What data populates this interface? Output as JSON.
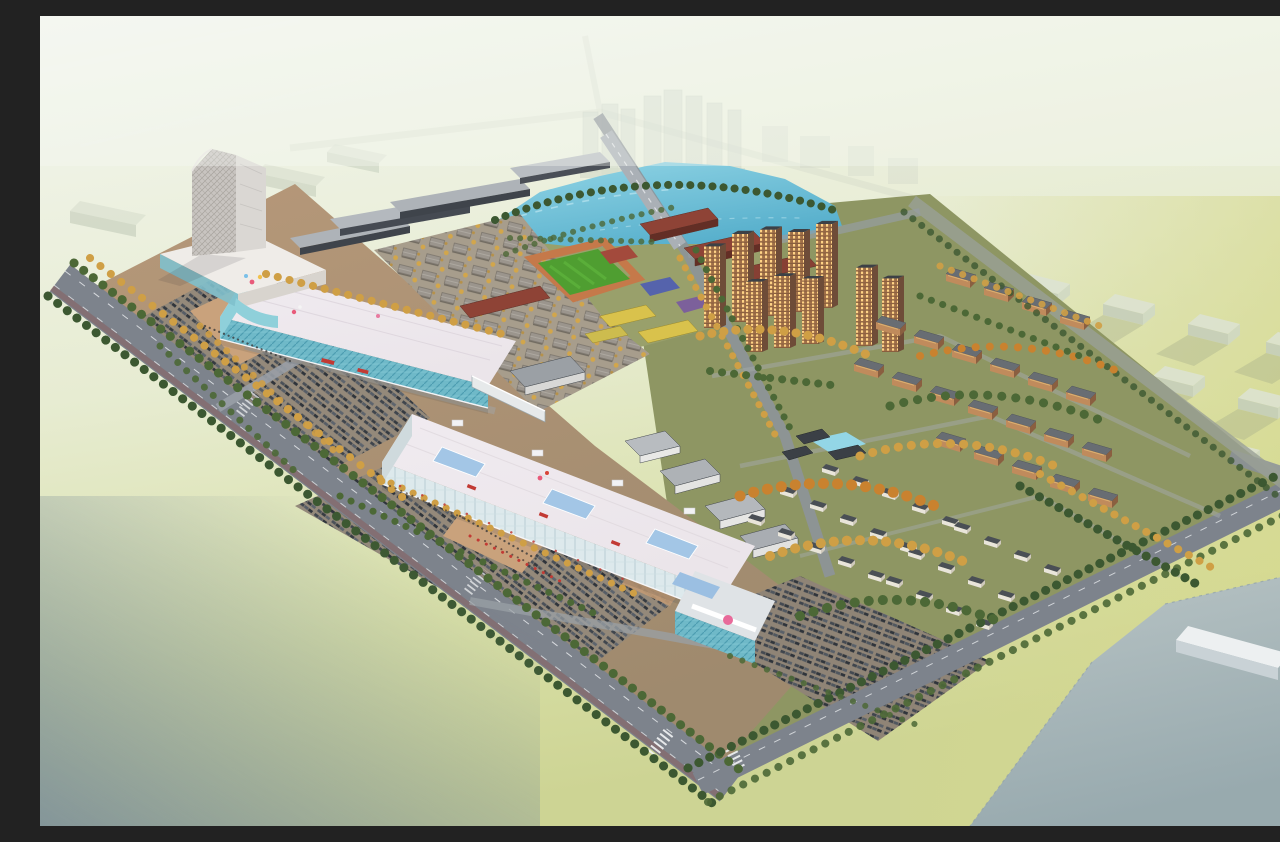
{
  "meta": {
    "title": "Aerial dusk rendering of a mixed-use development master plan",
    "type": "architectural-rendering",
    "view": "bird's-eye aerial",
    "time_of_day": "dusk"
  },
  "palette": {
    "bg_top": "#f3f6f0",
    "bg_mid": "#e7ecd2",
    "bg_green": "#d8dfa6",
    "bg_yellow": "#d6d98e",
    "corner_slate": "#7b8e99",
    "ghost_building": "#dde3d4",
    "ghost_shadow": "#9aa486",
    "parcel": "#b7c3ca",
    "white_slab": "#edf0f1",
    "site_tan": "#b69879",
    "site_tan_dark": "#9f8a6e",
    "site_residential": "#8e9663",
    "school_ground": "#99a06b",
    "road": "#7d838c",
    "road_minor": "#999fa6",
    "lane_marking": "#eceff1",
    "pond_deep": "#55aecb",
    "pond_light": "#93d6e6",
    "field_green": "#4f9e31",
    "track_orange": "#c5794a",
    "school_brick": "#8e4336",
    "kindergarten_yellow": "#d9c24c",
    "court_blue": "#5563ac",
    "court_red": "#a34a3c",
    "mall_roof": "#ebe5ea",
    "mall_glass": "#6fb9c8",
    "glass_light": "#8fd0da",
    "skylight_blue": "#a3c6e6",
    "tower_facade": "#c8c4c0",
    "tower_side": "#dad7d3",
    "podium_white": "#efece8",
    "townhouse_roof": "#9b958d",
    "tree_green": "#4c6836",
    "tree_autumn": "#cf9f45",
    "tree_orange": "#c9822f",
    "tree_dark": "#3c5831",
    "residential_wall": "#9f6f48",
    "residential_shade": "#6e4c38",
    "window_gold": "#ffd386",
    "roof_dark": "#3c4046",
    "midrise_roof": "#686d73",
    "midrise_wall": "#c08b5c",
    "villa_roof": "#4a4f55",
    "villa_wall": "#e9e5da",
    "parking_ground": "#94897a",
    "car_dark": "#3f454d",
    "plaza": "#c9a27c",
    "balloon_pink": "#e85a7a",
    "banner_red": "#c23a34",
    "logo_pink": "#e86a9a"
  },
  "scene": {
    "landmarks": [
      {
        "id": "office-tower",
        "label": "high-rise office tower with diagrid facade"
      },
      {
        "id": "retail-podium",
        "label": "white retail podium"
      },
      {
        "id": "shopping-mall-west",
        "label": "shopping mall block A with teal glass"
      },
      {
        "id": "shopping-mall-east",
        "label": "shopping mall block B with blue skylights"
      },
      {
        "id": "sky-bridge",
        "label": "sky bridge between malls"
      },
      {
        "id": "entrance-pavilion",
        "label": "glass entrance pavilion with pink logo"
      },
      {
        "id": "row-house-grid",
        "label": "dense grid of gray row houses"
      },
      {
        "id": "industrial-halls",
        "label": "long flat-roofed halls"
      },
      {
        "id": "school-campus",
        "label": "red-brick school campus"
      },
      {
        "id": "sports-field",
        "label": "soccer field with running track"
      },
      {
        "id": "kindergarten",
        "label": "yellow kindergarten buildings"
      },
      {
        "id": "pond",
        "label": "blue pond crossed by a road bridge"
      },
      {
        "id": "high-rise-cluster",
        "label": "orange residential towers with lit windows"
      },
      {
        "id": "midrise-apartments",
        "label": "mid-rise apartment blocks"
      },
      {
        "id": "villa-district",
        "label": "villa district with autumn trees"
      },
      {
        "id": "courtyard-garden",
        "label": "courtyard garden with small pond"
      },
      {
        "id": "parking-lots",
        "label": "surface parking lots full of cars"
      },
      {
        "id": "boulevard",
        "label": "tree-lined boulevard along the site"
      },
      {
        "id": "ghost-city",
        "label": "faded background city blocks"
      },
      {
        "id": "future-parcels",
        "label": "pale future development parcels"
      }
    ],
    "counts": {
      "high_rise_towers": 10,
      "midrise_blocks": 22,
      "villas": 27,
      "mall_skylights": 3,
      "background_slabs": 12,
      "parking_lots": 3
    }
  }
}
